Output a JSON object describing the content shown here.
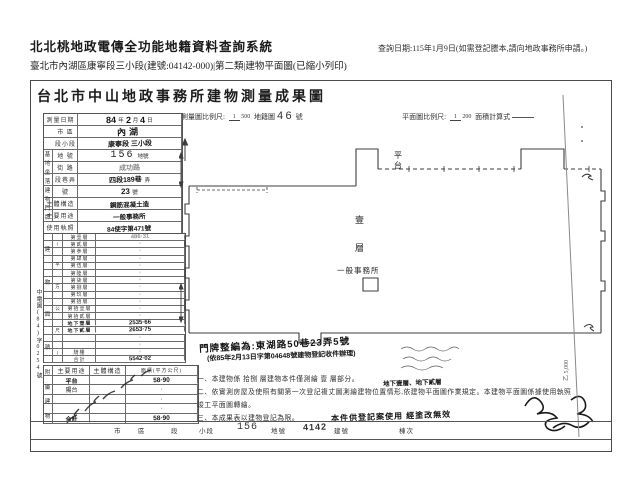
{
  "header": {
    "system_title": "北北桃地政電傳全功能地籍資料查詢系統",
    "query_date": "查詢日期:115年1月9日(如需登記謄本,請向地政事務所申請。)",
    "subtitle": "臺北市內湖區康寧段三小段(建號:04142-000)|第二類|建物平面圖(已縮小列印)"
  },
  "document": {
    "title": "台北市中山地政事務所建物測量成果圖",
    "scale_row": {
      "label1": "測量圖比例尺:",
      "scale1_num": "1",
      "scale1_den": "500",
      "map_label": "地籍圖",
      "map_no": "46",
      "map_unit": "號",
      "label2": "平面圖比例尺:",
      "scale2_num": "1",
      "scale2_den": "200",
      "calc_label": "面積計算式"
    },
    "info_table": {
      "survey_date_label": "測量日期",
      "survey_y": "84",
      "survey_y_unit": "年",
      "survey_m": "2",
      "survey_m_unit": "月",
      "survey_d": "4",
      "survey_d_unit": "日",
      "site_label": "基地坐落",
      "city_label": "市 區",
      "city": "內湖",
      "section_label": "段小段",
      "section": "康寧段 三小段",
      "lot_label": "地 號",
      "lot": "156",
      "lot_suffix": "地號",
      "door_label": "建物門牌",
      "street_label": "街 路",
      "street": "成功路",
      "lane_label": "段巷弄",
      "lane": "四段189巷",
      "lane_suffix": "弄",
      "no_label": "號",
      "no": "23",
      "no_suffix": "號",
      "structure_label": "主體構造",
      "structure": "鋼筋混凝土造",
      "use_label": "主要用途",
      "use": "一般事務所",
      "license_label": "使用執照",
      "license": "84使字第471號"
    },
    "floor_table": {
      "col_label": "建物面積",
      "col_sublabel": "(平方公尺)",
      "rows": [
        {
          "label": "第壹層",
          "value": "486·31",
          "hand": true,
          "faint": true
        },
        {
          "label": "第貳層",
          "value": "·"
        },
        {
          "label": "第參層",
          "value": "·"
        },
        {
          "label": "第肆層",
          "value": "·"
        },
        {
          "label": "第伍層",
          "value": "·"
        },
        {
          "label": "第陸層",
          "value": "·"
        },
        {
          "label": "第柒層",
          "value": "·"
        },
        {
          "label": "第捌層",
          "value": "·"
        },
        {
          "label": "第玖層",
          "value": "·"
        },
        {
          "label": "第拾層",
          "value": "·"
        },
        {
          "label": "第拾壹層",
          "value": "·"
        },
        {
          "label": "第拾貳層",
          "value": "·"
        },
        {
          "label": "地下壹層",
          "value": "2535·66",
          "hand": true,
          "hand_label": true
        },
        {
          "label": "地下貳層",
          "value": "2653·75",
          "hand": true,
          "hand_label": true
        },
        {
          "label": "",
          "value": "·"
        },
        {
          "label": "",
          "value": "·"
        },
        {
          "label": "騎樓",
          "value": "·"
        },
        {
          "label": "合計",
          "value": "5542·02",
          "hand": true
        }
      ]
    },
    "annex_table": {
      "group_label": "附屬建物",
      "headers": [
        "主要用途",
        "主體構造",
        "面積(平方公尺)"
      ],
      "rows": [
        {
          "use": "平台",
          "area": "58·90",
          "hand": true
        },
        {
          "use": "陽台",
          "area": "·"
        },
        {
          "use": "",
          "area": "·"
        },
        {
          "use": "",
          "area": "·"
        },
        {
          "use": "合計",
          "area": "58·90",
          "hand": true
        }
      ]
    },
    "margin_note": "中電圖(84)字0254號",
    "plan": {
      "platform_label": "平台",
      "floor_label_1": "壹",
      "floor_label_2": "層",
      "use_label": "一般事務所"
    },
    "handwritten": {
      "door_change": "門牌整編為:東湖路50巷23弄5號",
      "door_change2": "(依85年2月13日字第04648號建物登記收件辦理)",
      "floors_insert": "地下壹層、地下貳層",
      "note3_hand": "本件供登記案使用 經塗改無效"
    },
    "notes": [
      "一、本建物係 拾捌 層建物本件僅測繪 壹 層部分。",
      "二、依實測房屋及使照有關第一次登記複丈圖測繪建物位置情形,依建物平面圖作業規定。本建物平面圖係據使用執照竣工平面圖轉繪。",
      "三、本成果表以建物登記為限。"
    ],
    "bottom_strip": {
      "labels": [
        "市",
        "區",
        "段",
        "小段",
        "156",
        "地號",
        "4142",
        "建號",
        "棟次"
      ]
    },
    "paper_no": "乙 5,000"
  }
}
